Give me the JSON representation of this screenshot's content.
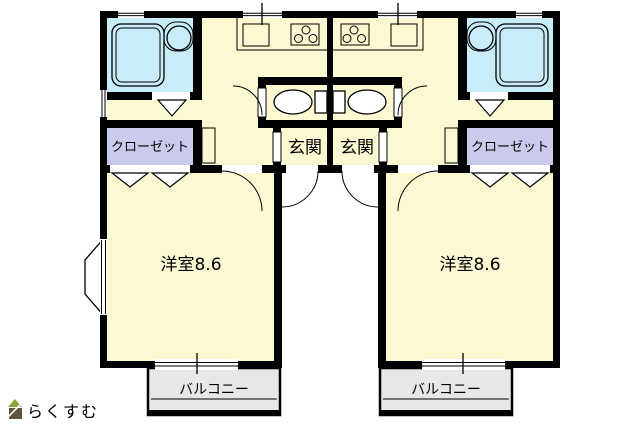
{
  "plan_title": "apartment-floor-plan",
  "colors": {
    "wall": "#000000",
    "room_cream": "#FCF8D2",
    "wet_blue": "#C8EDF8",
    "closet_lavender": "#CACAEC",
    "balcony_gray": "#E7E7E7",
    "logo_text": "#8B7C68",
    "logo_roof": "#8AA43C",
    "logo_body": "#63523F"
  },
  "units": {
    "left": {
      "closet_label": "クローゼット",
      "entrance_label": "玄関",
      "room_label": "洋室8.6",
      "balcony_label": "バルコニー"
    },
    "right": {
      "closet_label": "クローゼット",
      "entrance_label": "玄関",
      "room_label": "洋室8.6",
      "balcony_label": "バルコニー"
    }
  },
  "icons": [
    "bathtub-icon",
    "washbasin-icon",
    "toilet-icon",
    "gas-stove-icon",
    "kitchen-sink-icon",
    "door-arc-icon",
    "folding-door-icon",
    "sliding-door-icon",
    "window-icon",
    "bay-window-icon",
    "house-icon"
  ],
  "logo": {
    "text": "らくすむ"
  }
}
